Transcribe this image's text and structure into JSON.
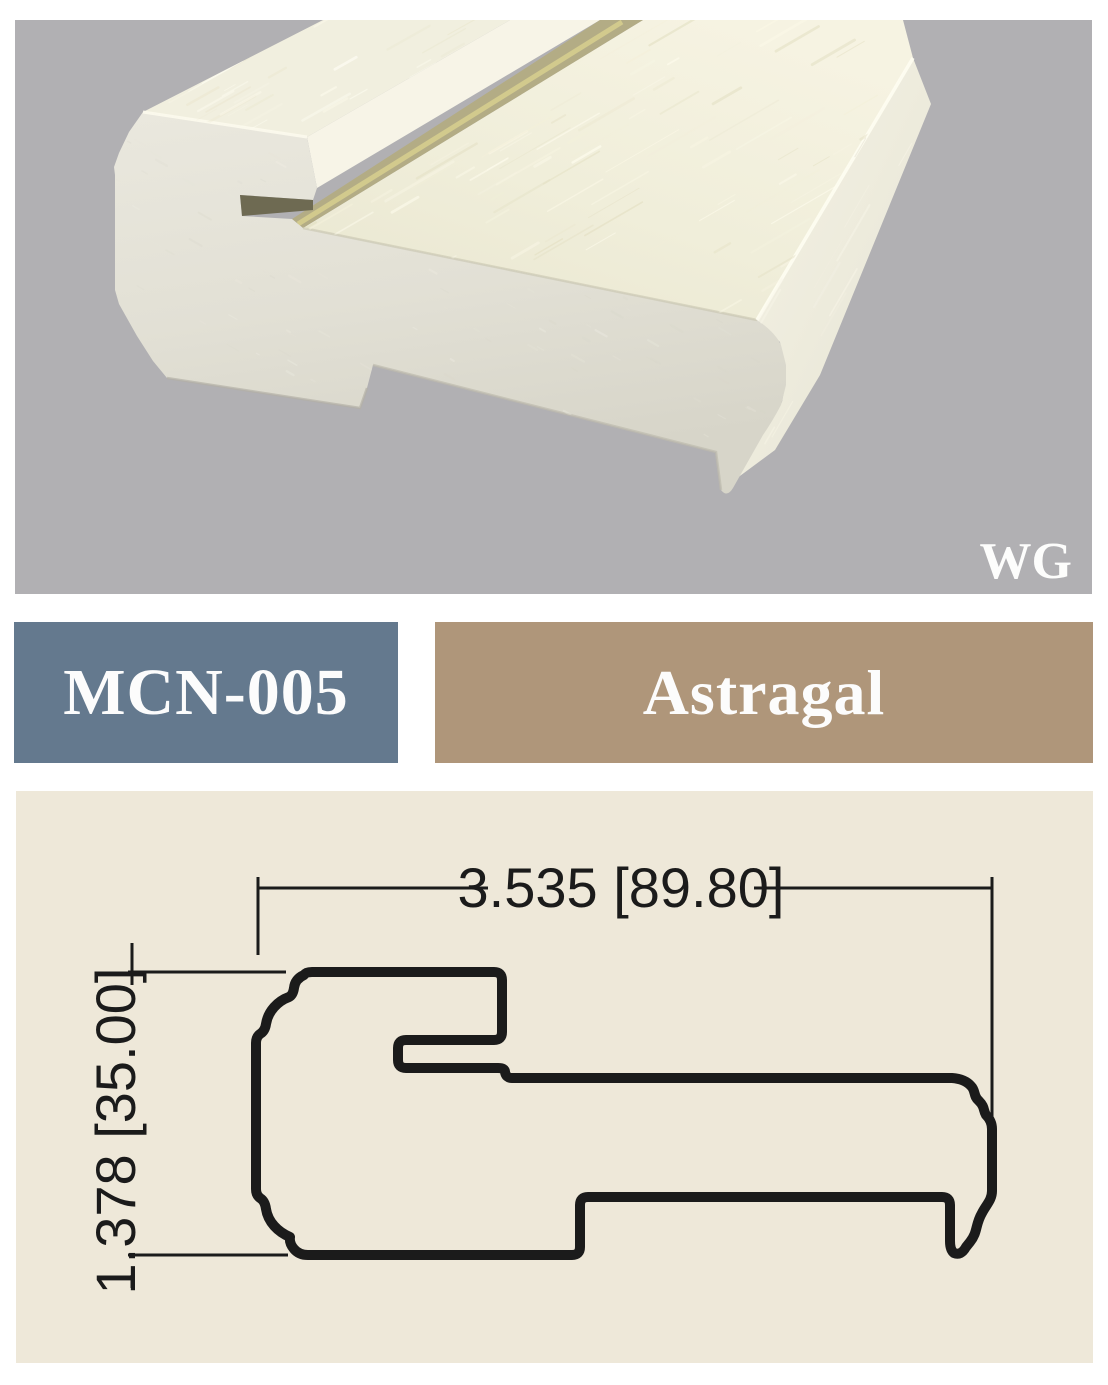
{
  "photo": {
    "watermark": "WG",
    "background_color": "#b1b0b3",
    "material_color": "#e9e6da",
    "grain_color": "#f1efdf"
  },
  "labels": {
    "code": {
      "text": "MCN-005",
      "background": "#64798e",
      "text_color": "#fcfcfc"
    },
    "profile_name": {
      "text": "Astragal",
      "background": "#af967a",
      "text_color": "#fcfcfc"
    }
  },
  "drawing": {
    "background": "#eee8d9",
    "line_color": "#1b1b1b",
    "width_dimension": "3.535 [89.80]",
    "height_dimension": "1.378 [35.00]",
    "width_inches": 3.535,
    "width_mm": 89.8,
    "height_inches": 1.378,
    "height_mm": 35.0
  }
}
